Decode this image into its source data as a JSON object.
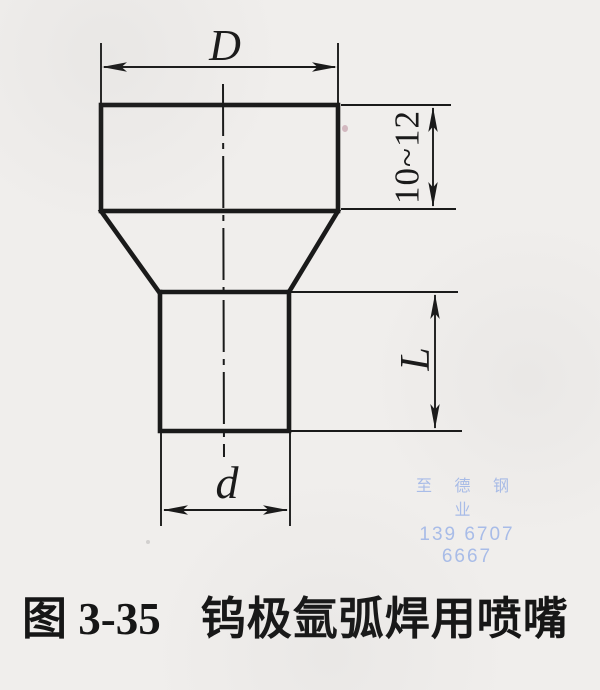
{
  "figure": {
    "caption_prefix": "图 3-35",
    "caption_title": "钨极氩弧焊用喷嘴"
  },
  "dimension_labels": {
    "outer_diameter": "D",
    "flange_height": "10~12",
    "body_length": "L",
    "tip_diameter": "d"
  },
  "watermark": {
    "company": "至 德 钢 业",
    "phone": "139 6707 6667"
  },
  "colors": {
    "paper": "#f0eeec",
    "ink": "#1a1a1a",
    "watermark_blue": "#a8bce8"
  }
}
